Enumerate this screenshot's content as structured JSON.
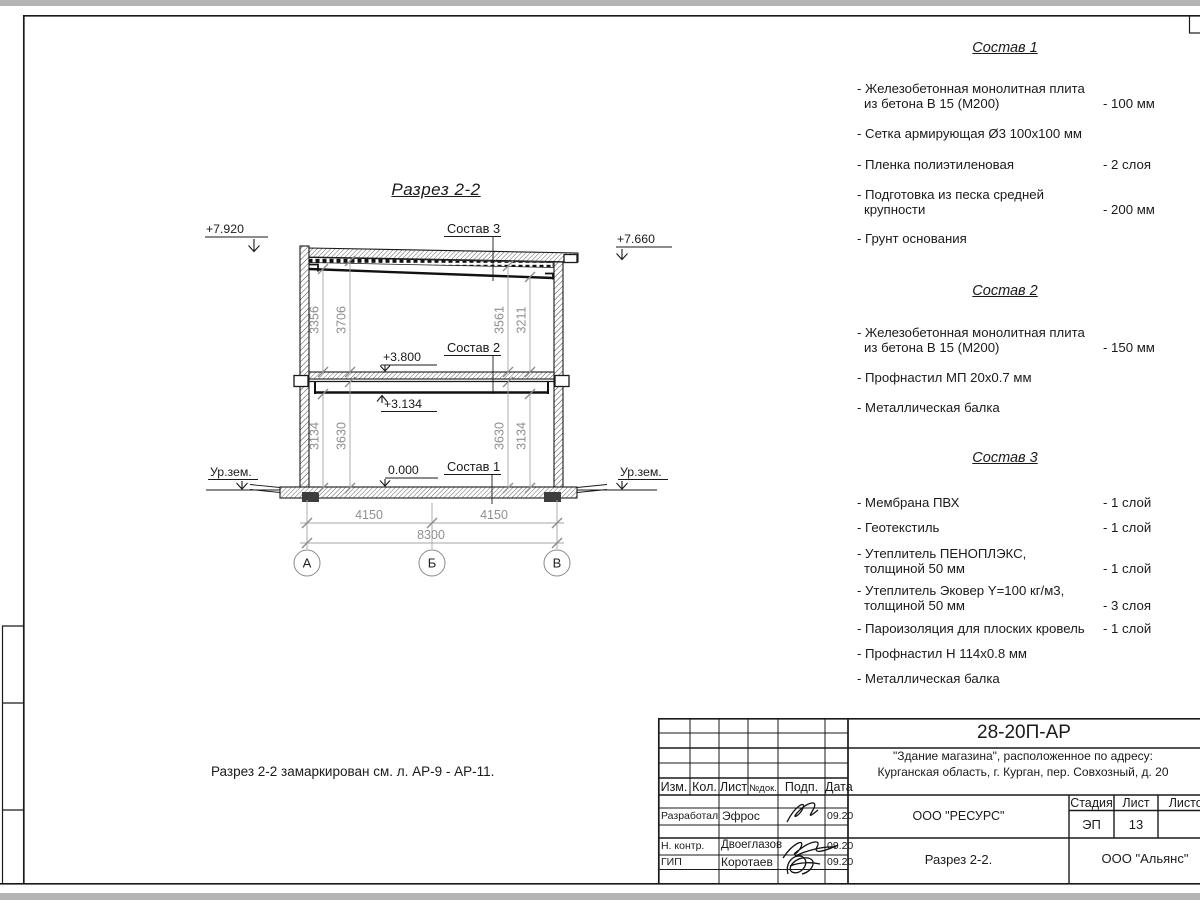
{
  "colors": {
    "background": "#b4b4b4",
    "paper": "#ffffff",
    "line": "#1a1a1a",
    "dim": "#8f8f8f"
  },
  "drawing": {
    "title": "Разрез 2-2",
    "note": "Разрез 2-2 замаркирован см. л. АР-9 - АР-11.",
    "elevations": {
      "roof_left": "+7.920",
      "roof_right": "+7.660",
      "floor": "+3.800",
      "beam": "+3.134",
      "zero": "0.000",
      "ground_left": "Ур.зем.",
      "ground_right": "Ур.зем."
    },
    "leaders": {
      "top": "Состав 3",
      "mid": "Состав 2",
      "bottom": "Состав 1"
    },
    "dims": {
      "upper_left_inner": "3356",
      "upper_left_outer": "3706",
      "upper_right_inner": "3561",
      "upper_right_outer": "3211",
      "lower_left_inner": "3134",
      "lower_left_outer": "3630",
      "lower_right_inner": "3630",
      "lower_right_outer": "3134",
      "span_left": "4150",
      "span_right": "4150",
      "span_total": "8300"
    },
    "axes": {
      "a": "А",
      "b": "Б",
      "c": "В"
    }
  },
  "s1": {
    "title": "Состав 1",
    "items": [
      {
        "l1": "- Железобетонная  монолитная плита",
        "l2": "из бетона В 15 (М200)",
        "v": "- 100 мм"
      },
      {
        "l1": "- Сетка армирующая Ø3 100х100 мм"
      },
      {
        "l1": "- Пленка полиэтиленовая",
        "v": "-  2 слоя"
      },
      {
        "l1": "- Подготовка из песка средней",
        "l2": "крупности",
        "v": "- 200 мм"
      },
      {
        "l1": "- Грунт основания"
      }
    ]
  },
  "s2": {
    "title": "Состав 2",
    "items": [
      {
        "l1": "- Железобетонная  монолитная плита",
        "l2": "из бетона В 15 (М200)",
        "v": "- 150 мм"
      },
      {
        "l1": "- Профнастил МП 20х0.7 мм"
      },
      {
        "l1": "- Металлическая балка"
      }
    ]
  },
  "s3": {
    "title": "Состав 3",
    "items": [
      {
        "l1": "- Мембрана ПВХ",
        "v": "- 1 слой"
      },
      {
        "l1": "- Геотекстиль",
        "v": "- 1 слой"
      },
      {
        "l1": "- Утеплитель ПЕНОПЛЭКС,",
        "l2": "толщиной 50 мм",
        "v": "- 1 слой"
      },
      {
        "l1": "- Утеплитель Эковер Y=100 кг/м3,",
        "l2": "толщиной 50 мм",
        "v": "- 3 слоя"
      },
      {
        "l1": "- Пароизоляция для плоских кровель",
        "v": "- 1 слой"
      },
      {
        "l1": "- Профнастил Н 114х0.8 мм"
      },
      {
        "l1": "- Металлическая балка"
      }
    ]
  },
  "titleblock": {
    "code": "28-20П-АР",
    "object_line1": "\"Здание магазина\", расположенное по адресу:",
    "object_line2": "Курганская область, г. Курган, пер. Совхозный, д. 20",
    "cols": {
      "izm": "Изм.",
      "kol": "Кол.",
      "list": "Лист",
      "ndok": "№док.",
      "podp": "Подп.",
      "data": "Дата"
    },
    "staff": [
      {
        "role": "Разработал",
        "name": "Эфрос",
        "date": "09.20"
      },
      {
        "role": "Н. контр.",
        "name": "Двоеглазов",
        "date": "09.20"
      },
      {
        "role": "ГИП",
        "name": "Коротаев",
        "date": "09.20"
      }
    ],
    "org": "ООО \"РЕСУРС\"",
    "stage_label": "Стадия",
    "sheet_label": "Лист",
    "sheets_label": "Листов",
    "stage": "ЭП",
    "sheet_num": "13",
    "doc_title": "Разрез 2-2.",
    "company": "ООО \"Альянс\""
  }
}
